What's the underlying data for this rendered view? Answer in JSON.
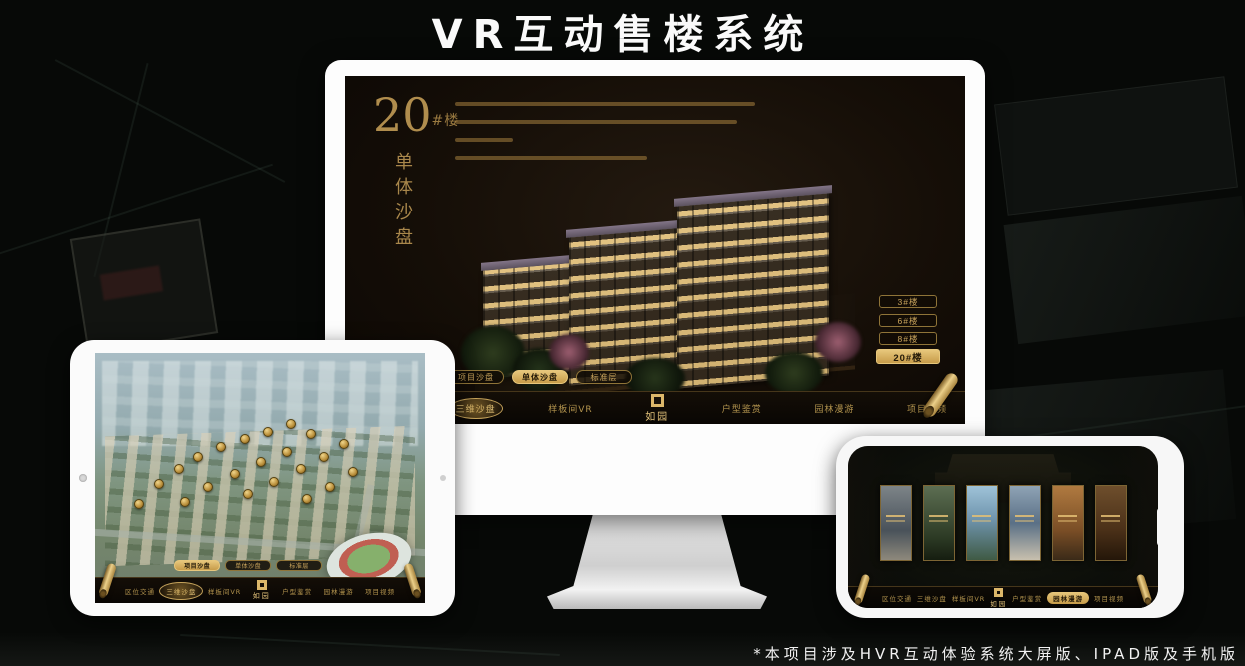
{
  "page": {
    "title": "VR互动售楼系统",
    "footnote": "*本项目涉及HVR互动体验系统大屏版、IPAD版及手机版"
  },
  "brand": {
    "logo_text": "如园"
  },
  "colors": {
    "gold": "#c9a45c",
    "gold_bright": "#e7c77c",
    "screen_dark": "#150e07"
  },
  "monitor": {
    "headline": {
      "number": "20",
      "suffix": "#楼",
      "vertical_title": "单体沙盘"
    },
    "floor_buttons": [
      {
        "label": "3#楼",
        "active": false
      },
      {
        "label": "6#楼",
        "active": false
      },
      {
        "label": "8#楼",
        "active": false
      },
      {
        "label": "20#楼",
        "active": true
      }
    ],
    "tabs": [
      {
        "label": "项目沙盘",
        "active": false
      },
      {
        "label": "单体沙盘",
        "active": true
      },
      {
        "label": "标准层",
        "active": false
      }
    ],
    "nav_items": [
      {
        "label": "区位交通",
        "active": false
      },
      {
        "label": "三维沙盘",
        "active": true
      },
      {
        "label": "样板间VR",
        "active": false
      },
      {
        "label": "户型鉴赏",
        "active": false
      },
      {
        "label": "园林漫游",
        "active": false
      },
      {
        "label": "项目视频",
        "active": false
      }
    ]
  },
  "tablet": {
    "tabs": [
      {
        "label": "项目沙盘",
        "active": true
      },
      {
        "label": "单体沙盘",
        "active": false
      },
      {
        "label": "标准层",
        "active": false
      }
    ],
    "nav_items": [
      {
        "label": "区位交通",
        "active": false
      },
      {
        "label": "三维沙盘",
        "active": true
      },
      {
        "label": "样板间VR",
        "active": false
      },
      {
        "label": "户型鉴赏",
        "active": false
      },
      {
        "label": "园林漫游",
        "active": false
      },
      {
        "label": "项目视频",
        "active": false
      }
    ],
    "badges": [
      {
        "x": 13,
        "y": 60
      },
      {
        "x": 19,
        "y": 52
      },
      {
        "x": 25,
        "y": 46
      },
      {
        "x": 31,
        "y": 41
      },
      {
        "x": 38,
        "y": 37
      },
      {
        "x": 45,
        "y": 34
      },
      {
        "x": 52,
        "y": 31
      },
      {
        "x": 59,
        "y": 28
      },
      {
        "x": 65,
        "y": 32
      },
      {
        "x": 58,
        "y": 39
      },
      {
        "x": 50,
        "y": 43
      },
      {
        "x": 42,
        "y": 48
      },
      {
        "x": 34,
        "y": 53
      },
      {
        "x": 27,
        "y": 59
      },
      {
        "x": 46,
        "y": 56
      },
      {
        "x": 54,
        "y": 51
      },
      {
        "x": 62,
        "y": 46
      },
      {
        "x": 69,
        "y": 41
      },
      {
        "x": 75,
        "y": 36
      },
      {
        "x": 71,
        "y": 53
      },
      {
        "x": 64,
        "y": 58
      },
      {
        "x": 78,
        "y": 47
      }
    ]
  },
  "phone": {
    "nav_items": [
      {
        "label": "区位交通",
        "active": false
      },
      {
        "label": "三维沙盘",
        "active": false
      },
      {
        "label": "样板间VR",
        "active": false
      },
      {
        "label": "户型鉴赏",
        "active": false
      },
      {
        "label": "园林漫游",
        "active": true
      },
      {
        "label": "项目视频",
        "active": false
      }
    ]
  }
}
